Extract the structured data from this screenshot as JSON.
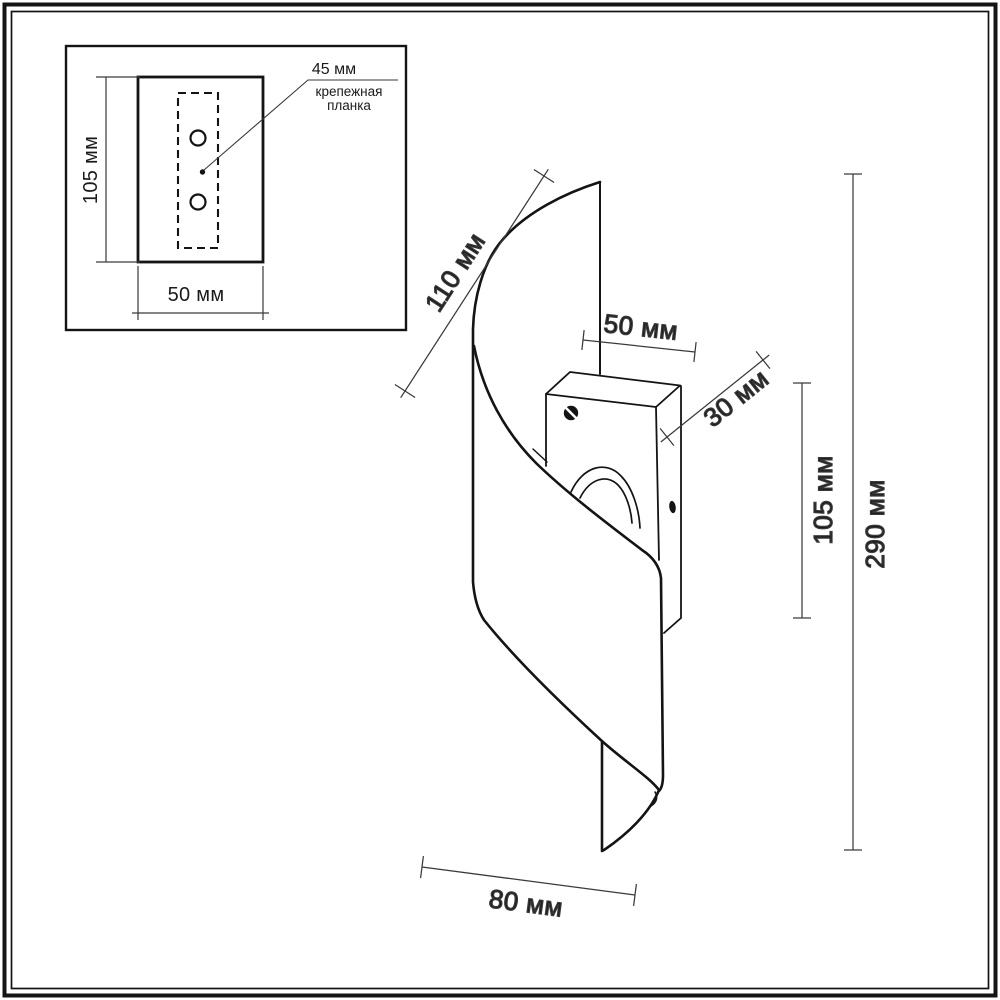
{
  "colors": {
    "line": "#141414",
    "dim_line": "#3a3a3a",
    "background": "#ffffff"
  },
  "inset": {
    "plate_height_label": "105 мм",
    "plate_width_label": "50 мм",
    "hole_spacing_label": "45 мм",
    "caption_line1": "крепежная",
    "caption_line2": "планка"
  },
  "lamp_dimensions": {
    "shade_edge_label": "110 мм",
    "backplate_width_label": "50 мм",
    "backplate_depth_label": "30 мм",
    "backplate_height_label": "105 мм",
    "total_height_label": "290 мм",
    "bottom_width_label": "80 мм"
  }
}
